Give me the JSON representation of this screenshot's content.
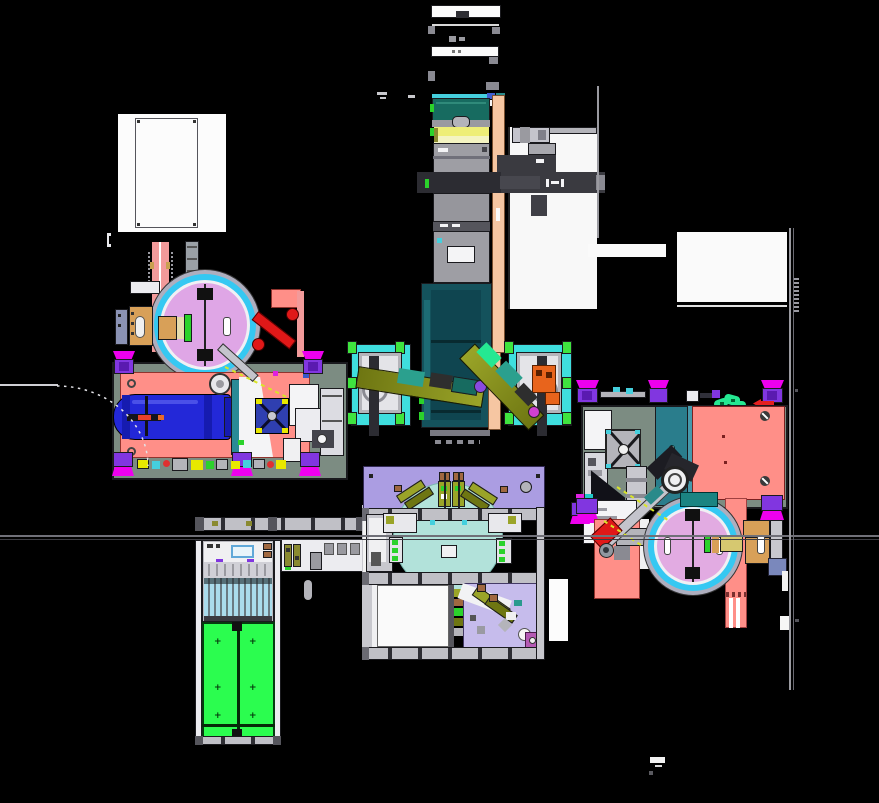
{
  "scene": {
    "width": 879,
    "height": 803,
    "background": "#000000"
  },
  "palette": {
    "bg": "#000000",
    "white": "#fbfbfb",
    "paper": "#f4f4f6",
    "lineGray": "#9a9aa0",
    "midGray": "#b4b4ba",
    "steel": "#c8c8ce",
    "darkSteel": "#8a8a92",
    "charcoal": "#2e2e34",
    "ink": "#1a1a1e",
    "armDark": "#3a3a40",
    "tealTop": "#176b60",
    "tealDeep": "#14525c",
    "tealDeeper": "#0f4550",
    "beltCyan": "#45cfdd",
    "yellow": "#eeee77",
    "yellowPale": "#f4f4c2",
    "cornYellow": "#e8e800",
    "peach": "#f6c6a2",
    "plateCyan": "#3fdede",
    "tabGreen": "#3fe43f",
    "glowGreen": "#25e892",
    "green": "#2bd22b",
    "oliveDark": "#6e7612",
    "oliveLight": "#9aa428",
    "armTeal": "#2ba08e",
    "orange": "#e8641c",
    "plum": "#dfa6e6",
    "plumRight": "#e2abe2",
    "ringCyan": "#35c8f2",
    "ringSilver": "#aeaebe",
    "salmon": "#ff8f88",
    "pinkStrip": "#f29a9a",
    "tankBlue": "#2328d8",
    "tankDark": "#161bb0",
    "valveRed": "#e8402a",
    "robotRed": "#e01818",
    "silver": "#c4c4cc",
    "footPurple": "#8136e0",
    "footViolet": "#5a1ab0",
    "footMagenta": "#ee00ee",
    "sage": "#7c8c82",
    "fanIndigo": "#2f3fb0",
    "doorGreen": "#2bfd4f",
    "trayCyan": "#aadcec",
    "lavender": "#ab9de2",
    "lavenderLight": "#c6bcec",
    "rotaryCyan": "#b2e2da",
    "tan": "#d8a058",
    "khaki": "#d6c870",
    "khakiPale": "#e6dcae",
    "blueSquare": "#5080e8",
    "tealPanel": "#2a7d8c",
    "tealPanelLight": "#4799ab",
    "tealHeader": "#1b8482",
    "brown": "#a06840",
    "arrowRed": "#e42020",
    "slateBlue": "#7a88bc",
    "sensorYellow": "#d8e428",
    "blueBox": "#60a8d8",
    "magentaBox": "#b45ab4",
    "violetJoint": "#8a4ae0"
  },
  "door_mark_glyph": "+"
}
